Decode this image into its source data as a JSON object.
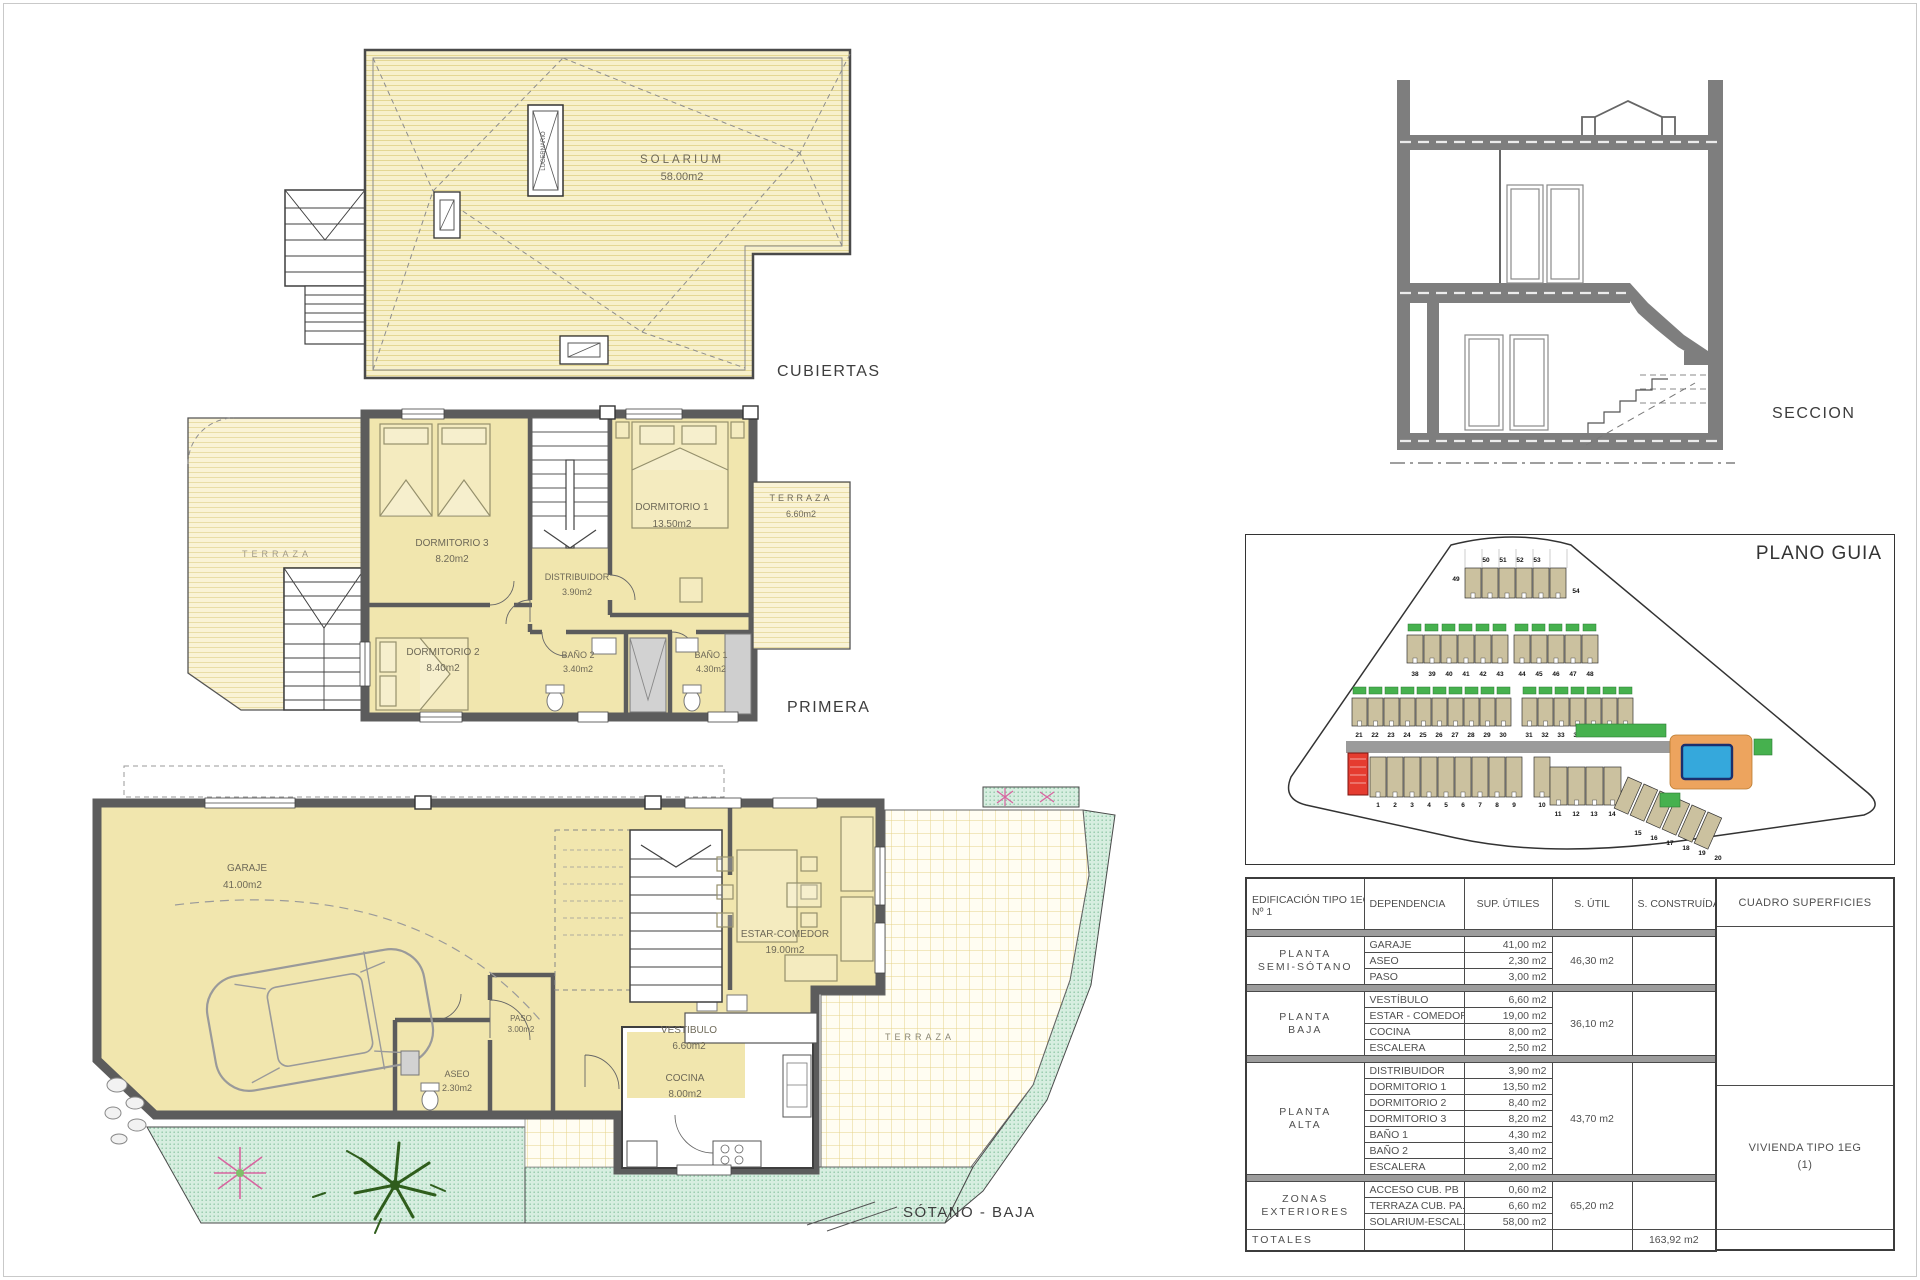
{
  "plans": {
    "cubiertas": {
      "label": "CUBIERTAS",
      "solarium": {
        "name": "SOLARIUM",
        "area": "58.00m2"
      },
      "lucernario": "LUCERNARIO"
    },
    "primera": {
      "label": "PRIMERA",
      "terraza_left": {
        "name": "TERRAZA"
      },
      "dormitorio3": {
        "name": "DORMITORIO 3",
        "area": "8.20m2"
      },
      "dormitorio1": {
        "name": "DORMITORIO 1",
        "area": "13.50m2"
      },
      "distribuidor": {
        "name": "DISTRIBUIDOR",
        "area": "3.90m2"
      },
      "dormitorio2": {
        "name": "DORMITORIO 2",
        "area": "8.40m2"
      },
      "bano2": {
        "name": "BAÑO 2",
        "area": "3.40m2"
      },
      "bano1": {
        "name": "BAÑO 1",
        "area": "4.30m2"
      },
      "terraza_right": {
        "name": "TERRAZA",
        "area": "6.60m2"
      }
    },
    "sotano_baja": {
      "label": "SÓTANO - BAJA",
      "garaje": {
        "name": "GARAJE",
        "area": "41.00m2"
      },
      "paso": {
        "name": "PASO",
        "area": "3.00m2"
      },
      "estar": {
        "name": "ESTAR-COMEDOR",
        "area": "19.00m2"
      },
      "vestibulo": {
        "name": "VESTIBULO",
        "area": "6.60m2"
      },
      "aseo": {
        "name": "ASEO",
        "area": "2.30m2"
      },
      "cocina": {
        "name": "COCINA",
        "area": "8.00m2"
      },
      "terraza": {
        "name": "TERRAZA"
      }
    },
    "seccion": {
      "label": "SECCION"
    },
    "plano_guia": {
      "label": "PLANO GUIA",
      "plot_rows": {
        "rowA": [
          "49",
          "50",
          "51",
          "52",
          "53",
          "54"
        ],
        "rowB": [
          "38",
          "39",
          "40",
          "41",
          "42",
          "43",
          "44",
          "45",
          "46",
          "47",
          "48"
        ],
        "rowC": [
          "21",
          "22",
          "23",
          "24",
          "25",
          "26",
          "27",
          "28",
          "29",
          "30",
          "31",
          "32",
          "33",
          "34",
          "35",
          "36",
          "37"
        ],
        "rowD": [
          "1",
          "2",
          "3",
          "4",
          "5",
          "6",
          "7",
          "8",
          "9",
          "10"
        ],
        "rowE": [
          "11",
          "12",
          "13",
          "14"
        ],
        "rowF": [
          "15",
          "16",
          "17",
          "18",
          "19",
          "20"
        ]
      },
      "highlighted_plot": "1"
    }
  },
  "table": {
    "header": {
      "col1_line1": "EDIFICACIÓN TIPO 1EG",
      "col1_line2": "Nº 1",
      "col2": "DEPENDENCIA",
      "col3": "SUP. ÚTILES",
      "col4": "S. ÚTIL",
      "col5": "S. CONSTRUÍDA",
      "col6": "CUADRO SUPERFICIES"
    },
    "groups": [
      {
        "floor": [
          "PLANTA",
          "SEMI-SÓTANO"
        ],
        "rooms": [
          [
            "GARAJE",
            "41,00 m2"
          ],
          [
            "ASEO",
            "2,30 m2"
          ],
          [
            "PASO",
            "3,00 m2"
          ]
        ],
        "sutil": "46,30 m2"
      },
      {
        "floor": [
          "PLANTA",
          "BAJA"
        ],
        "rooms": [
          [
            "VESTÍBULO",
            "6,60 m2"
          ],
          [
            "ESTAR - COMEDOR",
            "19,00 m2"
          ],
          [
            "COCINA",
            "8,00 m2"
          ],
          [
            "ESCALERA",
            "2,50 m2"
          ]
        ],
        "sutil": "36,10 m2"
      },
      {
        "floor": [
          "PLANTA",
          "ALTA"
        ],
        "rooms": [
          [
            "DISTRIBUIDOR",
            "3,90 m2"
          ],
          [
            "DORMITORIO 1",
            "13,50 m2"
          ],
          [
            "DORMITORIO 2",
            "8,40 m2"
          ],
          [
            "DORMITORIO 3",
            "8,20 m2"
          ],
          [
            "BAÑO 1",
            "4,30 m2"
          ],
          [
            "BAÑO 2",
            "3,40 m2"
          ],
          [
            "ESCALERA",
            "2,00 m2"
          ]
        ],
        "sutil": "43,70 m2"
      },
      {
        "floor": [
          "ZONAS",
          "EXTERIORES"
        ],
        "rooms": [
          [
            "ACCESO CUB. PB",
            "0,60 m2"
          ],
          [
            "TERRAZA CUB. PA.",
            "6,60 m2"
          ],
          [
            "SOLARIUM-ESCAL.",
            "58,00 m2"
          ]
        ],
        "sutil": "65,20 m2"
      }
    ],
    "totals": {
      "label": "TOTALES",
      "construida": "163,92 m2"
    },
    "vivienda": {
      "line1": "VIVIENDA TIPO 1EG",
      "line2": "(1)"
    }
  }
}
